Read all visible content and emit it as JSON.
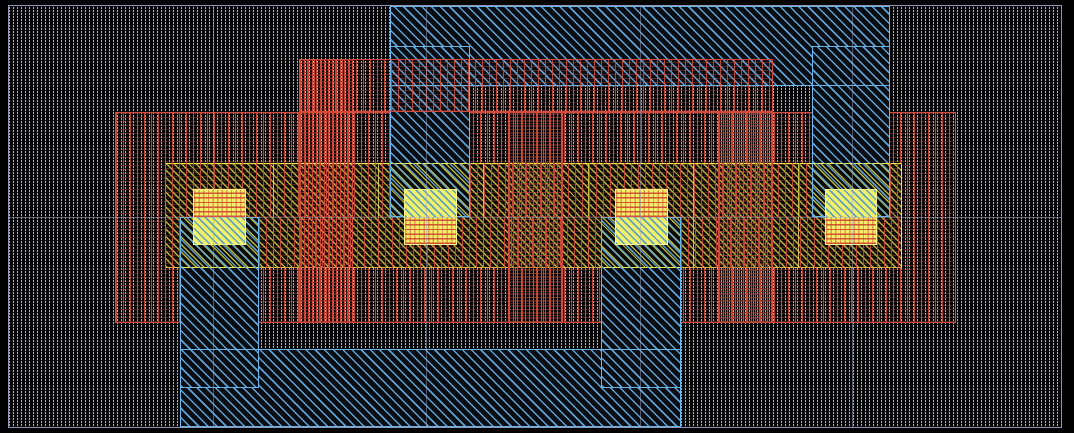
{
  "canvas": {
    "width": 1074,
    "height": 433,
    "background": "#000000",
    "description": "IC layout editor canvas, no visible text"
  },
  "palette": {
    "substrate_hatch": "#a9afc5",
    "substrate_border": "#9096b4",
    "metal_hatch": "#64aae0",
    "metal_border": "#66b6f0",
    "poly_hatch": "#d04c3a",
    "poly_border": "#d3493b",
    "diffusion_hatch": "#ccc83e",
    "diffusion_border": "#efec4d",
    "contact_fill": "#f2ef68",
    "grid_line": "#9ea3be"
  },
  "grid": {
    "vertical_x": [
      213,
      426,
      640,
      852
    ],
    "horizontal_y": [
      217
    ]
  },
  "shapes": [
    {
      "n": "substrate-well-region",
      "k": "well",
      "x": 8,
      "y": 5,
      "w": 1054,
      "h": 423,
      "b": "trbl",
      "bc": "#9096b4"
    },
    {
      "n": "metal-rail-top-fill",
      "k": "mo",
      "x": 390,
      "y": 6,
      "w": 500,
      "h": 80,
      "b": "",
      "bc": ""
    },
    {
      "n": "poly-main-region",
      "k": "rt",
      "x": 115,
      "y": 112,
      "w": 841,
      "h": 211,
      "b": "trbl",
      "bc": "#d3493b"
    },
    {
      "n": "metal-rail-bottom-fill",
      "k": "mo",
      "x": 180,
      "y": 349,
      "w": 501,
      "h": 78,
      "b": "",
      "bc": ""
    },
    {
      "n": "metal-strip-2-upper",
      "k": "mo",
      "x": 390,
      "y": 46,
      "w": 80,
      "h": 117,
      "b": "tlr",
      "bc": "#66b6f0"
    },
    {
      "n": "metal-strip-4-upper",
      "k": "mo",
      "x": 812,
      "y": 46,
      "w": 78,
      "h": 117,
      "b": "tlr",
      "bc": "#66b6f0"
    },
    {
      "n": "metal-strip-1-lower",
      "k": "mo",
      "x": 180,
      "y": 268,
      "w": 79,
      "h": 120,
      "b": "blr",
      "bc": "#66b6f0"
    },
    {
      "n": "metal-strip-3-lower",
      "k": "mo",
      "x": 601,
      "y": 268,
      "w": 80,
      "h": 120,
      "b": "blr",
      "bc": "#66b6f0"
    },
    {
      "n": "metal-rail-top-outline",
      "k": "out",
      "x": 390,
      "y": 6,
      "w": 500,
      "h": 80,
      "b": "trbl",
      "bc": "#66b6f0"
    },
    {
      "n": "metal-rail-bottom-outline",
      "k": "out",
      "x": 180,
      "y": 349,
      "w": 501,
      "h": 78,
      "b": "trbl",
      "bc": "#66b6f0"
    },
    {
      "n": "poly-top-strap",
      "k": "rt",
      "x": 299,
      "y": 59,
      "w": 474,
      "h": 53,
      "b": "trbl",
      "bc": "#d3493b"
    },
    {
      "n": "diffusion-band",
      "k": "band",
      "x": 165,
      "y": 163,
      "w": 737,
      "h": 105,
      "b": "trbl",
      "bc": "#efec4d"
    },
    {
      "n": "diffusion-cell-divider-1",
      "k": "div",
      "x": 273,
      "y": 164,
      "w": 1,
      "h": 103,
      "b": "",
      "bc": ""
    },
    {
      "n": "diffusion-cell-divider-2",
      "k": "div",
      "x": 378,
      "y": 164,
      "w": 1,
      "h": 103,
      "b": "",
      "bc": ""
    },
    {
      "n": "diffusion-cell-divider-3",
      "k": "div",
      "x": 483,
      "y": 164,
      "w": 1,
      "h": 103,
      "b": "",
      "bc": ""
    },
    {
      "n": "diffusion-cell-divider-4",
      "k": "div",
      "x": 588,
      "y": 164,
      "w": 1,
      "h": 103,
      "b": "",
      "bc": ""
    },
    {
      "n": "diffusion-cell-divider-5",
      "k": "div",
      "x": 693,
      "y": 164,
      "w": 1,
      "h": 103,
      "b": "",
      "bc": ""
    },
    {
      "n": "diffusion-cell-divider-6",
      "k": "div",
      "x": 798,
      "y": 164,
      "w": 1,
      "h": 103,
      "b": "",
      "bc": ""
    },
    {
      "n": "poly-over-diffusion-1",
      "k": "rt",
      "x": 165,
      "y": 163,
      "w": 225,
      "h": 54,
      "b": "",
      "bc": ""
    },
    {
      "n": "poly-over-diffusion-2",
      "k": "rt",
      "x": 470,
      "y": 163,
      "w": 342,
      "h": 54,
      "b": "",
      "bc": ""
    },
    {
      "n": "poly-over-diffusion-3",
      "k": "rt",
      "x": 890,
      "y": 163,
      "w": 12,
      "h": 54,
      "b": "",
      "bc": ""
    },
    {
      "n": "poly-over-diffusion-4",
      "k": "rt",
      "x": 165,
      "y": 217,
      "w": 15,
      "h": 51,
      "b": "",
      "bc": ""
    },
    {
      "n": "poly-over-diffusion-5",
      "k": "rt",
      "x": 259,
      "y": 217,
      "w": 342,
      "h": 51,
      "b": "",
      "bc": ""
    },
    {
      "n": "poly-over-diffusion-6",
      "k": "rt",
      "x": 681,
      "y": 217,
      "w": 221,
      "h": 51,
      "b": "",
      "bc": ""
    },
    {
      "n": "metal-strip-2-over-diffusion",
      "k": "mt",
      "x": 390,
      "y": 163,
      "w": 80,
      "h": 54,
      "b": "blr",
      "bc": "#66b6f0"
    },
    {
      "n": "metal-strip-4-over-diffusion",
      "k": "mt",
      "x": 812,
      "y": 163,
      "w": 78,
      "h": 54,
      "b": "blr",
      "bc": "#66b6f0"
    },
    {
      "n": "metal-strip-1-over-diffusion",
      "k": "mt",
      "x": 180,
      "y": 217,
      "w": 79,
      "h": 51,
      "b": "tlr",
      "bc": "#66b6f0"
    },
    {
      "n": "metal-strip-3-over-diffusion",
      "k": "mt",
      "x": 601,
      "y": 217,
      "w": 80,
      "h": 51,
      "b": "tlr",
      "bc": "#66b6f0"
    },
    {
      "n": "contact-1-poly-half",
      "k": "cr",
      "x": 193,
      "y": 189,
      "w": 53,
      "h": 28,
      "b": "tlr",
      "bc": "#f7f48a"
    },
    {
      "n": "contact-1-metal-half",
      "k": "cb",
      "x": 193,
      "y": 217,
      "w": 53,
      "h": 28,
      "b": "blr",
      "bc": "#f7f48a"
    },
    {
      "n": "contact-2-metal-half",
      "k": "cb",
      "x": 404,
      "y": 189,
      "w": 53,
      "h": 28,
      "b": "tlr",
      "bc": "#f7f48a"
    },
    {
      "n": "contact-2-poly-half",
      "k": "cr",
      "x": 404,
      "y": 217,
      "w": 53,
      "h": 28,
      "b": "blr",
      "bc": "#f7f48a"
    },
    {
      "n": "contact-3-poly-half",
      "k": "cr",
      "x": 615,
      "y": 189,
      "w": 53,
      "h": 28,
      "b": "tlr",
      "bc": "#f7f48a"
    },
    {
      "n": "contact-3-metal-half",
      "k": "cb",
      "x": 615,
      "y": 217,
      "w": 53,
      "h": 28,
      "b": "blr",
      "bc": "#f7f48a"
    },
    {
      "n": "contact-4-metal-half",
      "k": "cb",
      "x": 825,
      "y": 189,
      "w": 52,
      "h": 28,
      "b": "tlr",
      "bc": "#f7f48a"
    },
    {
      "n": "contact-4-poly-half",
      "k": "cr",
      "x": 825,
      "y": 217,
      "w": 52,
      "h": 28,
      "b": "blr",
      "bc": "#f7f48a"
    },
    {
      "n": "poly-gate-1",
      "k": "gate",
      "x": 299,
      "y": 59,
      "w": 54,
      "h": 264,
      "b": "trbl",
      "bc": "#d3493b"
    },
    {
      "n": "poly-gate-2",
      "k": "gate",
      "x": 508,
      "y": 112,
      "w": 55,
      "h": 211,
      "b": "trbl",
      "bc": "#d3493b"
    },
    {
      "n": "poly-gate-3",
      "k": "gate",
      "x": 718,
      "y": 112,
      "w": 55,
      "h": 211,
      "b": "trbl",
      "bc": "#d3493b"
    },
    {
      "n": "grid-line-vertical-1",
      "k": "gridv",
      "x": 213,
      "y": 5,
      "w": 1,
      "h": 423,
      "b": "",
      "bc": ""
    },
    {
      "n": "grid-line-vertical-2",
      "k": "gridv",
      "x": 426,
      "y": 5,
      "w": 1,
      "h": 423,
      "b": "",
      "bc": ""
    },
    {
      "n": "grid-line-vertical-3",
      "k": "gridv",
      "x": 640,
      "y": 5,
      "w": 1,
      "h": 423,
      "b": "",
      "bc": ""
    },
    {
      "n": "grid-line-vertical-4",
      "k": "gridv",
      "x": 852,
      "y": 5,
      "w": 1,
      "h": 423,
      "b": "",
      "bc": ""
    },
    {
      "n": "grid-line-horizontal-1",
      "k": "gridh",
      "x": 8,
      "y": 217,
      "w": 1054,
      "h": 1,
      "b": "",
      "bc": ""
    }
  ]
}
